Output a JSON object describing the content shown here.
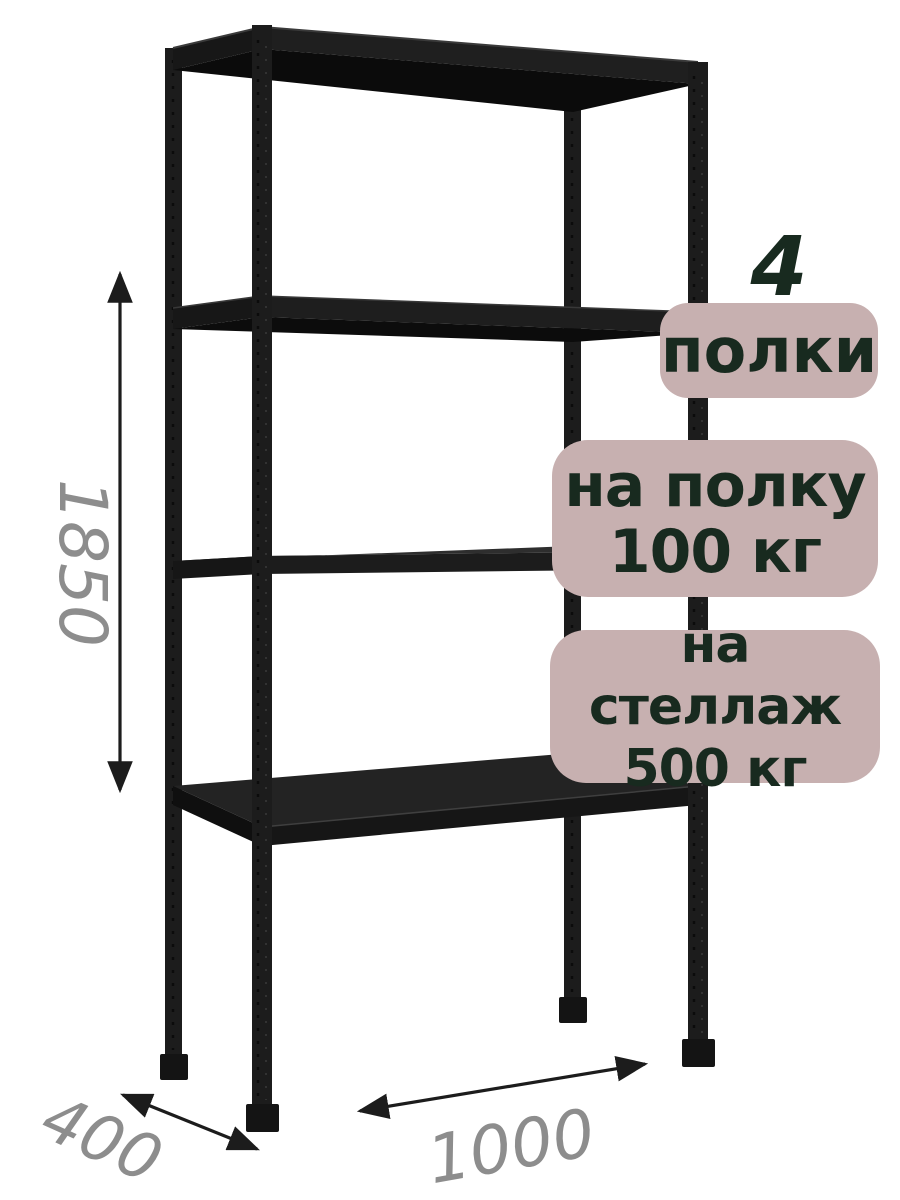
{
  "illustration": {
    "subject": "black-metal-shelving-rack",
    "shelf_count_drawn": 4,
    "metal_color": "#1d1d1d",
    "background_color": "#ffffff"
  },
  "dimensions": {
    "height_mm": "1850",
    "depth_mm": "400",
    "width_mm": "1000",
    "label_color": "#8d8d8d",
    "arrow_color": "#1c1c1c"
  },
  "badges": {
    "background_color": "#c7b0b0",
    "text_color": "#182a1f",
    "shelf_count": {
      "number": "4",
      "label": "полки"
    },
    "per_shelf_load": {
      "line1": "на полку",
      "line2": "100 кг"
    },
    "per_rack_load": {
      "line1": "на стеллаж",
      "line2": "500 кг"
    }
  }
}
